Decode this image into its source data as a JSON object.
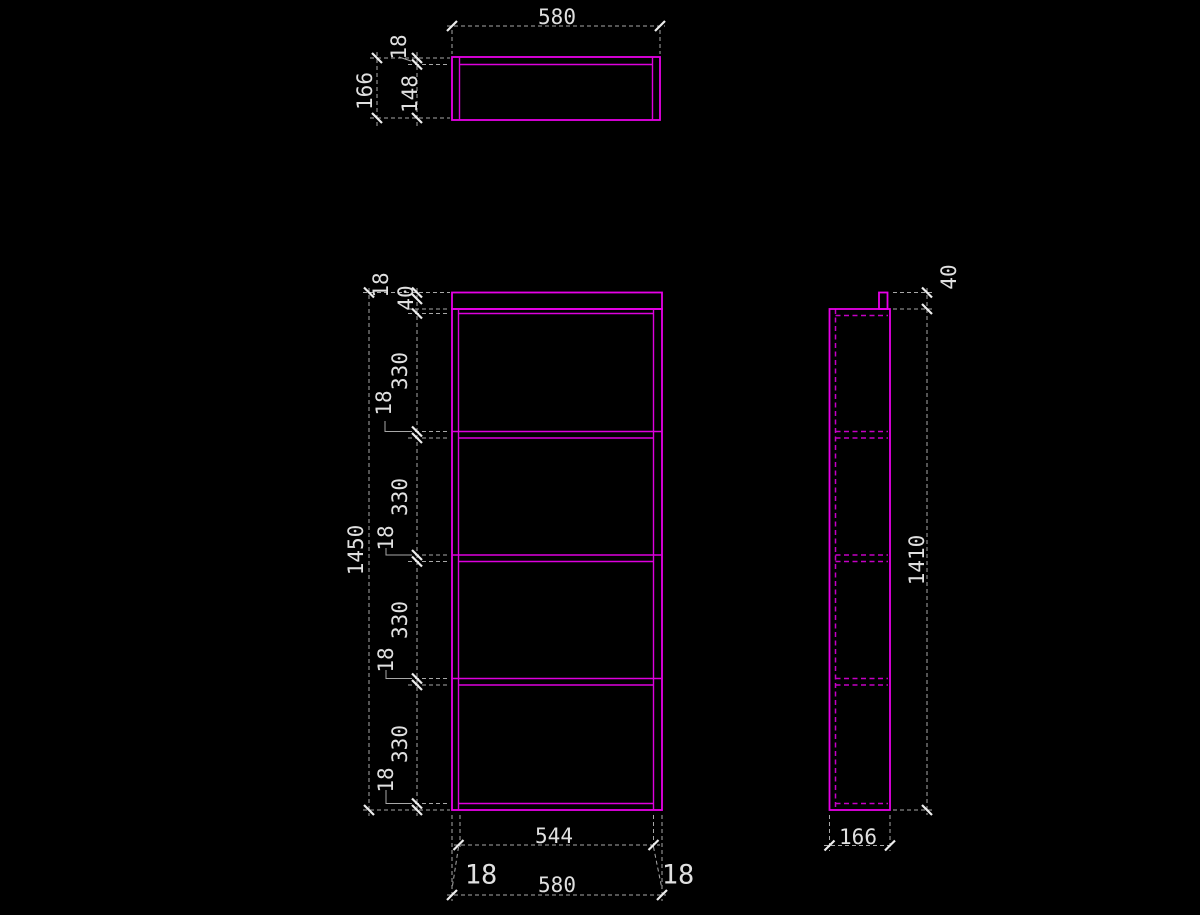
{
  "document": {
    "type": "cad-orthographic-drawing",
    "subject": "shelf cabinet",
    "background": "#000000"
  },
  "colors": {
    "edge": "#dd00dd",
    "edge_bright": "#e800e8",
    "hidden": "#c400c4",
    "dim_line": "#a8a8a8",
    "dim_text": "#e0e0e0",
    "tick": "#ededed"
  },
  "views": {
    "top_view": {
      "overall_width": "580",
      "overall_depth": "166",
      "back_panel_thickness": "18",
      "inner_depth": "148"
    },
    "front_view": {
      "overall_height": "1450",
      "overall_width": "580",
      "inner_width": "544",
      "side_panel_thickness": "18",
      "height_chain_top_to_bottom": [
        "18",
        "40",
        "330",
        "18",
        "330",
        "18",
        "330",
        "18",
        "330",
        "18"
      ],
      "width_chain": [
        "18",
        "544",
        "18"
      ]
    },
    "side_view": {
      "body_height": "1410",
      "depth": "166",
      "rail_above_top": "40"
    }
  },
  "geometry": {
    "solid_rects": [
      [
        452,
        57,
        208,
        63
      ],
      [
        452,
        292.5,
        210,
        16.5
      ],
      [
        452,
        309,
        210,
        501
      ],
      [
        879,
        292.5,
        8.5,
        16.5
      ],
      [
        829.5,
        309,
        60.5,
        501
      ]
    ],
    "solid_lines": [
      [
        459.5,
        57,
        459.5,
        120
      ],
      [
        652.5,
        57,
        652.5,
        120
      ],
      [
        459.5,
        64.5,
        652.5,
        64.5
      ],
      [
        458.5,
        309,
        458.5,
        810
      ],
      [
        653.5,
        309,
        653.5,
        810
      ],
      [
        458.5,
        313.5,
        653.5,
        313.5
      ],
      [
        452,
        431.5,
        662,
        431.5
      ],
      [
        458.5,
        438,
        653.5,
        438
      ],
      [
        452,
        555,
        662,
        555
      ],
      [
        458.5,
        561.5,
        653.5,
        561.5
      ],
      [
        452,
        678.5,
        662,
        678.5
      ],
      [
        458.5,
        685,
        653.5,
        685
      ],
      [
        458.5,
        803.5,
        653.5,
        803.5
      ]
    ],
    "hidden_lines": [
      [
        835.5,
        309,
        835.5,
        810
      ],
      [
        835.5,
        315.5,
        888,
        315.5
      ],
      [
        835.5,
        431.5,
        888,
        431.5
      ],
      [
        835.5,
        438,
        888,
        438
      ],
      [
        835.5,
        555,
        888,
        555
      ],
      [
        835.5,
        561.5,
        888,
        561.5
      ],
      [
        835.5,
        678.5,
        888,
        678.5
      ],
      [
        835.5,
        685,
        888,
        685
      ],
      [
        835.5,
        803.5,
        888,
        803.5
      ]
    ],
    "dim_lines": [
      [
        447,
        26,
        665,
        26
      ],
      [
        452,
        30,
        452,
        54
      ],
      [
        660,
        30,
        660,
        54
      ],
      [
        377,
        52,
        377,
        126
      ],
      [
        417,
        52,
        417,
        126
      ],
      [
        370,
        58,
        450,
        58
      ],
      [
        408,
        64.5,
        450,
        64.5
      ],
      [
        370,
        118,
        450,
        118
      ],
      [
        369,
        288,
        369,
        816
      ],
      [
        417,
        288,
        417,
        816
      ],
      [
        363,
        292.5,
        450,
        292.5
      ],
      [
        408,
        309,
        450,
        309
      ],
      [
        408,
        313.5,
        450,
        313.5
      ],
      [
        408,
        431.5,
        450,
        431.5
      ],
      [
        408,
        438,
        450,
        438
      ],
      [
        408,
        555,
        450,
        555
      ],
      [
        408,
        561.5,
        450,
        561.5
      ],
      [
        408,
        678.5,
        450,
        678.5
      ],
      [
        408,
        685,
        450,
        685
      ],
      [
        408,
        803.5,
        450,
        803.5
      ],
      [
        363,
        810,
        450,
        810
      ],
      [
        454,
        845,
        660,
        845
      ],
      [
        447,
        895,
        666,
        895
      ],
      [
        452,
        815,
        452,
        901
      ],
      [
        460,
        815,
        460,
        850
      ],
      [
        653.5,
        815,
        653.5,
        850
      ],
      [
        662,
        815,
        662,
        901
      ],
      [
        458.5,
        847,
        452,
        889
      ],
      [
        653.5,
        847,
        662,
        889
      ],
      [
        927,
        288,
        927,
        815
      ],
      [
        893,
        292.5,
        933,
        292.5
      ],
      [
        893,
        309,
        933,
        309
      ],
      [
        893,
        810,
        933,
        810
      ],
      [
        824,
        845.5,
        894,
        845.5
      ],
      [
        829.5,
        815,
        829.5,
        851
      ],
      [
        890,
        815,
        890,
        851
      ]
    ],
    "leader_lines": [
      [
        399,
        57,
        411,
        61
      ],
      [
        385,
        421,
        385,
        431.5,
        410,
        431.5
      ],
      [
        386,
        548,
        386,
        555,
        410,
        555
      ],
      [
        386,
        670,
        386,
        678.5,
        410,
        678.5
      ],
      [
        386,
        790,
        386,
        803.5,
        410,
        803.5
      ]
    ],
    "ticks_h": [
      [
        452,
        26
      ],
      [
        660,
        26
      ],
      [
        458.5,
        845
      ],
      [
        653.5,
        845
      ],
      [
        452,
        895
      ],
      [
        662,
        895
      ],
      [
        829.5,
        845.5
      ],
      [
        890,
        845.5
      ]
    ],
    "ticks_v": [
      [
        377,
        58
      ],
      [
        377,
        118
      ],
      [
        417,
        58
      ],
      [
        417,
        64.5
      ],
      [
        417,
        118
      ],
      [
        369,
        292.5
      ],
      [
        369,
        810
      ],
      [
        417,
        292.5
      ],
      [
        417,
        299
      ],
      [
        417,
        313.5
      ],
      [
        417,
        431.5
      ],
      [
        417,
        438
      ],
      [
        417,
        555
      ],
      [
        417,
        561.5
      ],
      [
        417,
        678.5
      ],
      [
        417,
        685
      ],
      [
        417,
        803.5
      ],
      [
        417,
        810
      ],
      [
        927,
        292.5
      ],
      [
        927,
        309
      ],
      [
        927,
        810
      ]
    ],
    "labels": [
      {
        "text": "580",
        "x": 557,
        "y": 17,
        "rot": 0,
        "size": 21
      },
      {
        "text": "18",
        "x": 399,
        "y": 47,
        "rot": -90,
        "size": 21
      },
      {
        "text": "166",
        "x": 365,
        "y": 91,
        "rot": -90,
        "size": 21
      },
      {
        "text": "148",
        "x": 410,
        "y": 94,
        "rot": -90,
        "size": 21
      },
      {
        "text": "1450",
        "x": 356,
        "y": 550,
        "rot": -90,
        "size": 21
      },
      {
        "text": "18",
        "x": 381,
        "y": 285,
        "rot": -90,
        "size": 21
      },
      {
        "text": "40",
        "x": 406,
        "y": 298,
        "rot": -90,
        "size": 21
      },
      {
        "text": "330",
        "x": 400,
        "y": 371,
        "rot": -90,
        "size": 21
      },
      {
        "text": "18",
        "x": 384,
        "y": 403,
        "rot": -90,
        "size": 21
      },
      {
        "text": "330",
        "x": 400,
        "y": 497,
        "rot": -90,
        "size": 21
      },
      {
        "text": "18",
        "x": 386,
        "y": 538,
        "rot": -90,
        "size": 21
      },
      {
        "text": "330",
        "x": 400,
        "y": 620,
        "rot": -90,
        "size": 21
      },
      {
        "text": "18",
        "x": 386,
        "y": 660,
        "rot": -90,
        "size": 21
      },
      {
        "text": "330",
        "x": 400,
        "y": 744,
        "rot": -90,
        "size": 21
      },
      {
        "text": "18",
        "x": 386,
        "y": 780,
        "rot": -90,
        "size": 21
      },
      {
        "text": "544",
        "x": 554,
        "y": 836,
        "rot": 0,
        "size": 21
      },
      {
        "text": "580",
        "x": 557,
        "y": 885,
        "rot": 0,
        "size": 21
      },
      {
        "text": "18",
        "x": 481,
        "y": 875,
        "rot": 0,
        "size": 27
      },
      {
        "text": "18",
        "x": 678,
        "y": 875,
        "rot": 0,
        "size": 27
      },
      {
        "text": "40",
        "x": 949,
        "y": 277,
        "rot": -90,
        "size": 21
      },
      {
        "text": "1410",
        "x": 917,
        "y": 560,
        "rot": -90,
        "size": 21
      },
      {
        "text": "166",
        "x": 858,
        "y": 837,
        "rot": 0,
        "size": 21
      }
    ]
  }
}
